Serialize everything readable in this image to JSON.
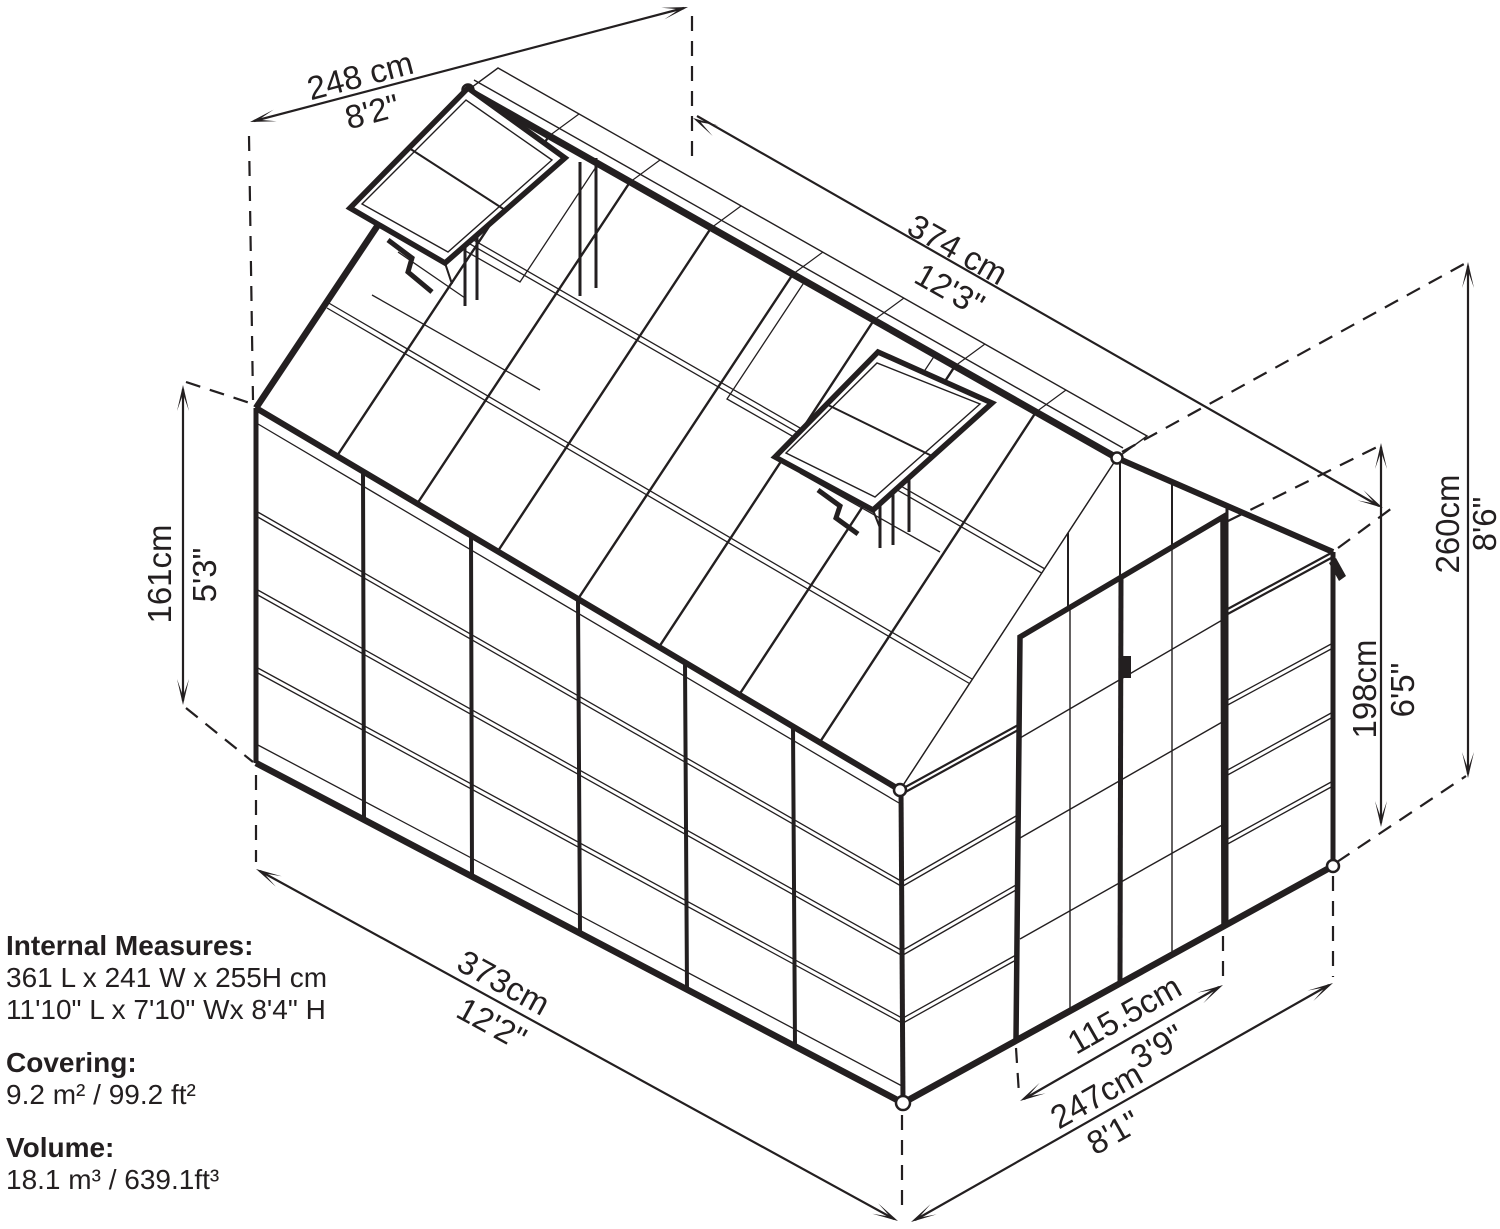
{
  "dimensions": {
    "back_width": {
      "metric": "248 cm",
      "imperial": "8'2\""
    },
    "roof_length": {
      "metric": "374 cm",
      "imperial": "12'3\""
    },
    "wall_height": {
      "metric": "161cm",
      "imperial": "5'3\""
    },
    "ridge_height": {
      "metric": "260cm",
      "imperial": "8'6\""
    },
    "door_height": {
      "metric": "198cm",
      "imperial": "6'5\""
    },
    "base_length": {
      "metric": "373cm",
      "imperial": "12'2\""
    },
    "door_width": {
      "metric": "115.5cm",
      "imperial": "3'9\""
    },
    "front_width": {
      "metric": "247cm",
      "imperial": "8'1\""
    }
  },
  "specs": {
    "internal_heading": "Internal Measures:",
    "internal_metric": "361 L x 241 W x 255H cm",
    "internal_imperial": "11'10\" L x 7'10\" Wx 8'4\" H",
    "covering_heading": "Covering:",
    "covering_value": "9.2 m² / 99.2 ft²",
    "volume_heading": "Volume:",
    "volume_value": "18.1 m³ / 639.1ft³"
  },
  "colors": {
    "line": "#231f20",
    "background": "#ffffff"
  }
}
